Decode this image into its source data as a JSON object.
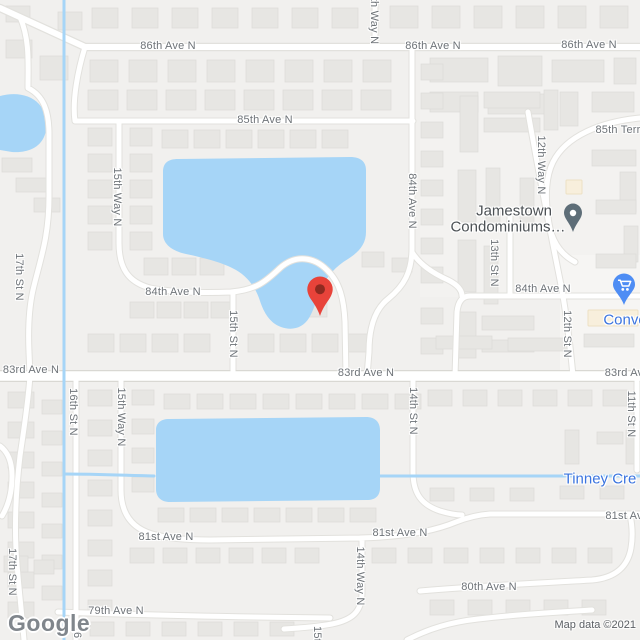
{
  "app": {
    "name": "Google Maps map view"
  },
  "attribution": {
    "logo": "Google",
    "map_data": "Map data ©2021"
  },
  "palette": {
    "land": "#F1F0EE",
    "water": "#A6D5F7",
    "road_fill": "#FFFFFF",
    "road_casing": "#E2E1DD",
    "major_road_casing": "#D9D8D3",
    "building": "#E7E6E3",
    "building_stroke": "#DCDBD7",
    "commercial_building": "#F8EFDC",
    "commercial_building_stroke": "#EDE0C3",
    "street_label": "#6E7378",
    "poi_dark_label": "#4B5054",
    "poi_blue": "#3B74DF",
    "water_label": "#3B74DF",
    "destination_pin": "#E8433A",
    "destination_pin_core": "#8F2A20",
    "poi_pin": "#5E6E78",
    "store_pin": "#4E8DF4"
  },
  "labels": [
    {
      "text": "86th Ave N",
      "x": 168,
      "y": 46,
      "kind": "street"
    },
    {
      "text": "86th Ave N",
      "x": 433,
      "y": 46,
      "kind": "street"
    },
    {
      "text": "86th Ave N",
      "x": 589,
      "y": 45,
      "kind": "street"
    },
    {
      "text": "85th Ave N",
      "x": 265,
      "y": 120,
      "kind": "street"
    },
    {
      "text": "85th Terr",
      "x": 618,
      "y": 130,
      "kind": "street"
    },
    {
      "text": "84th Ave N",
      "x": 173,
      "y": 292,
      "kind": "street"
    },
    {
      "text": "84th Ave N",
      "x": 543,
      "y": 289,
      "kind": "street"
    },
    {
      "text": "83rd Ave N",
      "x": 31,
      "y": 370,
      "kind": "street"
    },
    {
      "text": "83rd Ave N",
      "x": 366,
      "y": 373,
      "kind": "street"
    },
    {
      "text": "83rd Av",
      "x": 624,
      "y": 373,
      "kind": "street"
    },
    {
      "text": "81st Ave N",
      "x": 166,
      "y": 537,
      "kind": "street"
    },
    {
      "text": "81st Ave N",
      "x": 400,
      "y": 533,
      "kind": "street"
    },
    {
      "text": "81st Av",
      "x": 624,
      "y": 516,
      "kind": "street"
    },
    {
      "text": "80th Ave N",
      "x": 489,
      "y": 587,
      "kind": "street"
    },
    {
      "text": "79th Ave N",
      "x": 116,
      "y": 611,
      "kind": "street"
    },
    {
      "text": "th Way N",
      "x": 374,
      "y": 21,
      "kind": "street",
      "rot": true
    },
    {
      "text": "15th Way N",
      "x": 117,
      "y": 197,
      "kind": "street",
      "rot": true
    },
    {
      "text": "15th St N",
      "x": 233,
      "y": 334,
      "kind": "street",
      "rot": true
    },
    {
      "text": "17th St N",
      "x": 19,
      "y": 277,
      "kind": "street",
      "rot": true
    },
    {
      "text": "17th St N",
      "x": 12,
      "y": 572,
      "kind": "street",
      "rot": true
    },
    {
      "text": "16th St N",
      "x": 73,
      "y": 412,
      "kind": "street",
      "rot": true
    },
    {
      "text": "16",
      "x": 77,
      "y": 632,
      "kind": "street",
      "rot": true
    },
    {
      "text": "15th Way N",
      "x": 121,
      "y": 417,
      "kind": "street",
      "rot": true
    },
    {
      "text": "14th St N",
      "x": 413,
      "y": 411,
      "kind": "street",
      "rot": true
    },
    {
      "text": "14th Way N",
      "x": 360,
      "y": 576,
      "kind": "street",
      "rot": true
    },
    {
      "text": "13th St N",
      "x": 494,
      "y": 263,
      "kind": "street",
      "rot": true
    },
    {
      "text": "12th Way N",
      "x": 541,
      "y": 165,
      "kind": "street",
      "rot": true
    },
    {
      "text": "12th St N",
      "x": 567,
      "y": 334,
      "kind": "street",
      "rot": true
    },
    {
      "text": "11th St N",
      "x": 631,
      "y": 414,
      "kind": "street",
      "rot": true
    },
    {
      "text": "84th Ave N",
      "x": 412,
      "y": 201,
      "kind": "street",
      "rot": true
    },
    {
      "text": "15t",
      "x": 317,
      "y": 634,
      "kind": "street",
      "rot": true
    },
    {
      "text": "Jamestown",
      "x": 514,
      "y": 211,
      "kind": "poi"
    },
    {
      "text": "Condominiums…",
      "x": 508,
      "y": 227,
      "kind": "poi"
    },
    {
      "text": "Conve",
      "x": 625,
      "y": 320,
      "kind": "poi-blue"
    },
    {
      "text": "Tinney Cre",
      "x": 600,
      "y": 479,
      "kind": "water"
    }
  ],
  "markers": {
    "destination": {
      "x": 320,
      "y": 318
    },
    "jamestown": {
      "x": 573,
      "y": 233
    },
    "store": {
      "x": 624,
      "y": 306
    }
  }
}
